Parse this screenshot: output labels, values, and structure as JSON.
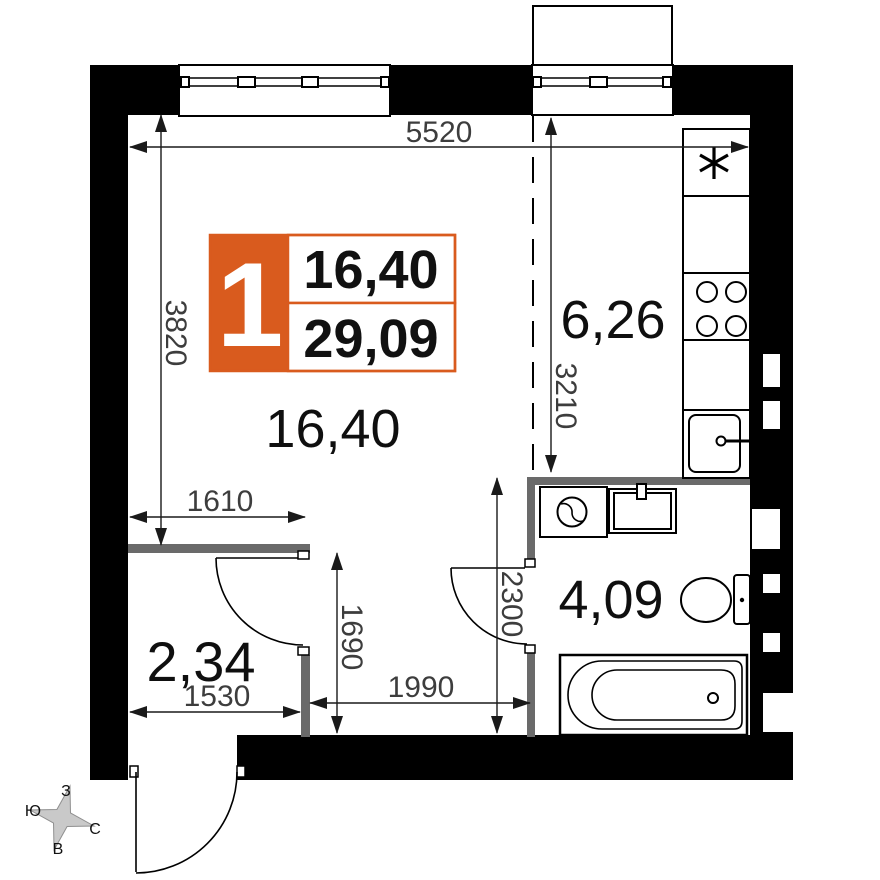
{
  "badge": {
    "number": "1",
    "living_area": "16,40",
    "total_area": "29,09"
  },
  "rooms": {
    "living": "16,40",
    "kitchen": "6,26",
    "bathroom": "4,09",
    "hallway": "2,34"
  },
  "dims": {
    "top": "5520",
    "left": "3820",
    "kitchen_zone": "3210",
    "hall_width": "1610",
    "hall_bottom": "1530",
    "corridor": "1990",
    "hall_height": "1690",
    "bath_height": "2300"
  },
  "compass": {
    "top": "З",
    "left": "Ю",
    "right": "С",
    "bottom": "В"
  },
  "colors": {
    "accent_orange": "#d95b1e",
    "wall_black": "#000000",
    "partition_gray": "#6a6a6a",
    "dim_text": "#3d3d3d"
  }
}
